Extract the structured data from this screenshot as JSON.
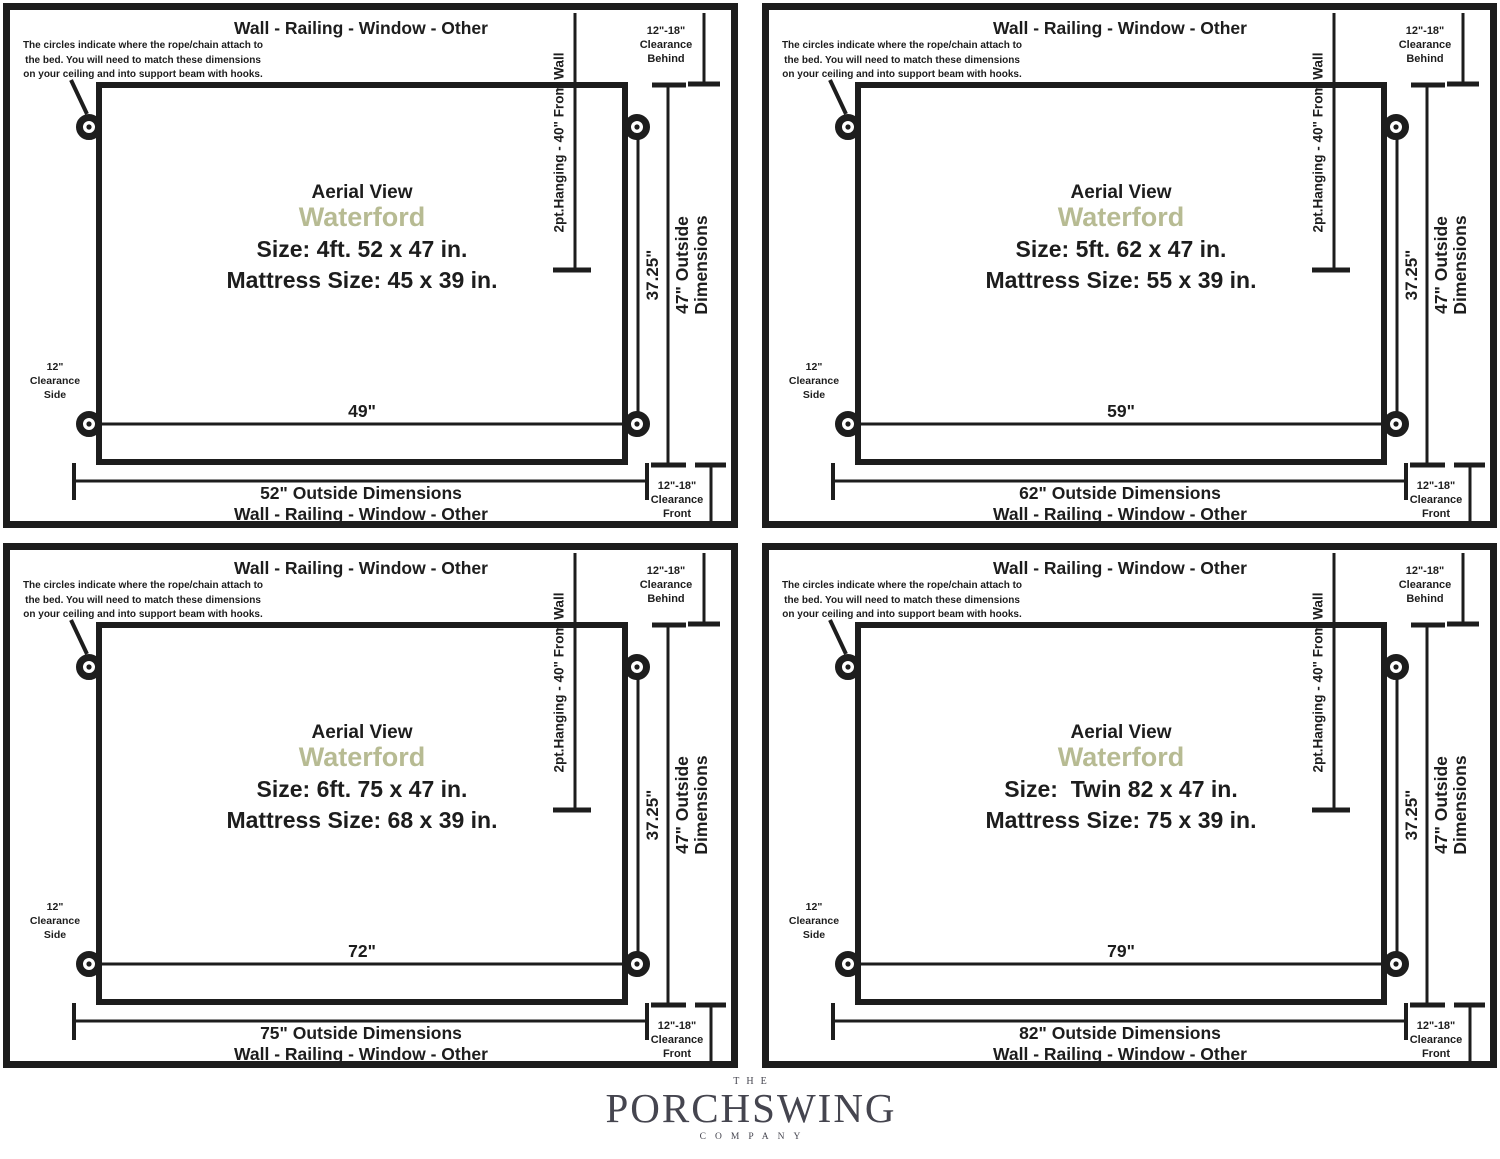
{
  "colors": {
    "ink": "#1d1d1d",
    "model_accent": "#b7bb93",
    "logo": "#45454f"
  },
  "shared": {
    "wall_label_top": "Wall - Railing - Window - Other",
    "annotation": "The circles indicate where the rope/chain attach to\nthe bed. You will need to match these dimensions\non your ceiling and into support beam with hooks.",
    "clearance_behind": "12\"-18\"\nClearance\nBehind",
    "clearance_side": "12\"\nClearance\nSide",
    "clearance_front": "12\"-18\"\nClearance\nFront",
    "hanging_label": "2pt.Hanging - 40\" From Wall",
    "hang_width_label": "37.25\"",
    "outside_height_label": "47\" Outside\nDimensions",
    "aerial_label": "Aerial View",
    "model_name": "Waterford",
    "wall_label_bottom": "Wall - Railing - Window - Other"
  },
  "panels": [
    {
      "size_label": "Size: 4ft. 52 x 47 in.",
      "mattress_label": "Mattress Size: 45 x 39 in.",
      "attach_width_label": "49\"",
      "outside_width_label": "52\" Outside Dimensions"
    },
    {
      "size_label": "Size: 5ft. 62 x 47 in.",
      "mattress_label": "Mattress Size: 55 x 39 in.",
      "attach_width_label": "59\"",
      "outside_width_label": "62\" Outside Dimensions"
    },
    {
      "size_label": "Size: 6ft. 75 x 47 in.",
      "mattress_label": "Mattress Size: 68 x 39 in.",
      "attach_width_label": "72\"",
      "outside_width_label": "75\" Outside Dimensions"
    },
    {
      "size_label": "Size:  Twin 82 x 47 in.",
      "mattress_label": "Mattress Size: 75 x 39 in.",
      "attach_width_label": "79\"",
      "outside_width_label": "82\" Outside Dimensions"
    }
  ],
  "logo": {
    "the": "THE",
    "name": "PORCHSWING",
    "company": "COMPANY"
  }
}
